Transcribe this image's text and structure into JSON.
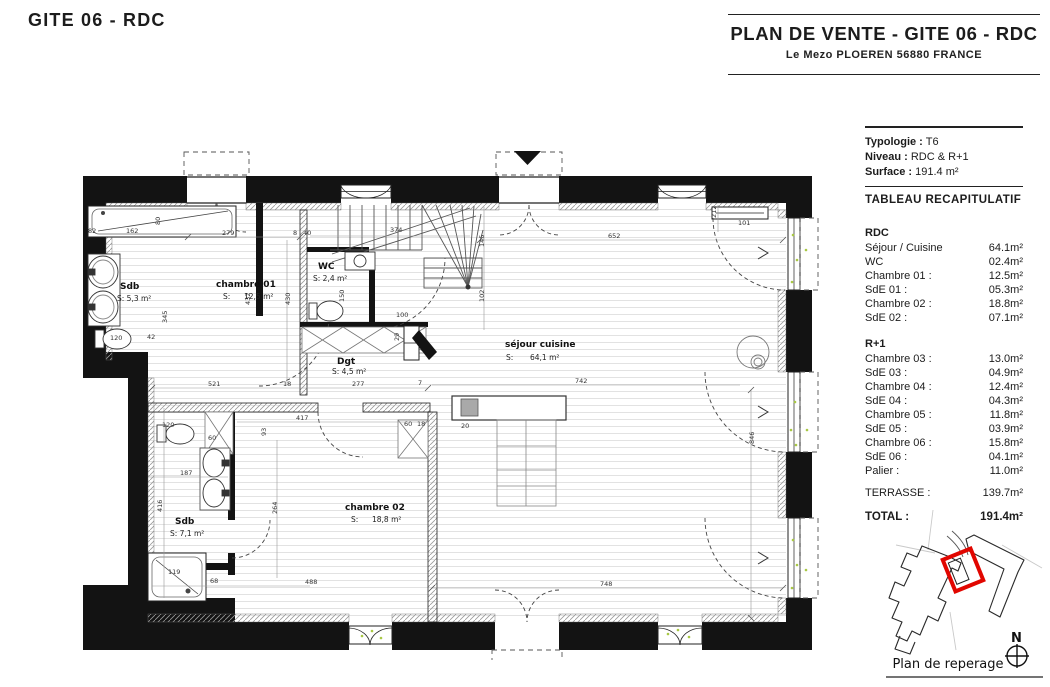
{
  "page_title": "GITE 06 - RDC",
  "header": {
    "title": "PLAN DE VENTE - GITE 06 - RDC",
    "subtitle": "Le Mezo PLOEREN 56880 FRANCE"
  },
  "info": {
    "typologie_label": "Typologie :",
    "typologie_value": "T6",
    "niveau_label": "Niveau :",
    "niveau_value": "RDC & R+1",
    "surface_label": "Surface :",
    "surface_value": "191.4 m²",
    "table_title": "TABLEAU RECAPITULATIF",
    "rdc_title": "RDC",
    "rdc_rows": [
      {
        "label": "Séjour / Cuisine",
        "value": "64.1m²"
      },
      {
        "label": "WC",
        "value": "02.4m²"
      },
      {
        "label": "Chambre 01 :",
        "value": "12.5m²"
      },
      {
        "label": "SdE 01 :",
        "value": "05.3m²"
      },
      {
        "label": "Chambre 02 :",
        "value": "18.8m²"
      },
      {
        "label": "SdE 02 :",
        "value": "07.1m²"
      }
    ],
    "r1_title": "R+1",
    "r1_rows": [
      {
        "label": "Chambre 03 :",
        "value": "13.0m²"
      },
      {
        "label": "SdE 03 :",
        "value": "04.9m²"
      },
      {
        "label": "Chambre 04 :",
        "value": "12.4m²"
      },
      {
        "label": "SdE 04 :",
        "value": "04.3m²"
      },
      {
        "label": "Chambre 05 :",
        "value": "11.8m²"
      },
      {
        "label": "SdE 05 :",
        "value": "03.9m²"
      },
      {
        "label": "Chambre 06 :",
        "value": "15.8m²"
      },
      {
        "label": "SdE 06 :",
        "value": "04.1m²"
      },
      {
        "label": "Palier :",
        "value": "11.0m²"
      }
    ],
    "terrasse_label": "TERRASSE :",
    "terrasse_value": "139.7m²",
    "total_label": "TOTAL :",
    "total_value": "191.4m²"
  },
  "plan": {
    "rooms": {
      "sdb1": {
        "name": "Sdb",
        "area": "S: 5,3 m²"
      },
      "ch01": {
        "name": "chambre 01",
        "s": "S:",
        "area": "12,5 m²"
      },
      "wc": {
        "name": "WC",
        "area": "S: 2,4 m²"
      },
      "dgt": {
        "name": "Dgt",
        "area": "S: 4,5 m²"
      },
      "sejour": {
        "name": "séjour cuisine",
        "s": "S:",
        "area": "64,1 m²"
      },
      "ch02": {
        "name": "chambre 02",
        "s": "S:",
        "area": "18,8 m²"
      },
      "sdb2": {
        "name": "Sdb",
        "area": "S: 7,1 m²"
      }
    },
    "dims": {
      "d82": "82",
      "d162": "162",
      "d80": "80",
      "d279": "279",
      "d8": "8",
      "d40": "40",
      "d374": "374",
      "d652": "652",
      "d101": "101",
      "d212": "212",
      "d145": "145",
      "d102": "102",
      "d432": "432",
      "d430": "430",
      "d345": "345",
      "d120a": "120",
      "d42": "42",
      "d150": "150",
      "d100": "100",
      "d29": "29",
      "d521": "521",
      "d18a": "18",
      "d277": "277",
      "d7": "7",
      "d417": "417",
      "d93": "93",
      "d264": "264",
      "d187": "187",
      "d416": "416",
      "d68": "68",
      "d488": "488",
      "d748": "748",
      "d742": "742",
      "d846": "846",
      "d60a": "60",
      "d18b": "18",
      "d20": "20",
      "d60b": "60",
      "d119": "119",
      "d120b": "120"
    }
  },
  "reperage": {
    "label": "Plan de reperage",
    "north": "N"
  },
  "colors": {
    "wall": "#131313",
    "highlight_red": "#e10600",
    "grass_green": "#a9c845"
  }
}
